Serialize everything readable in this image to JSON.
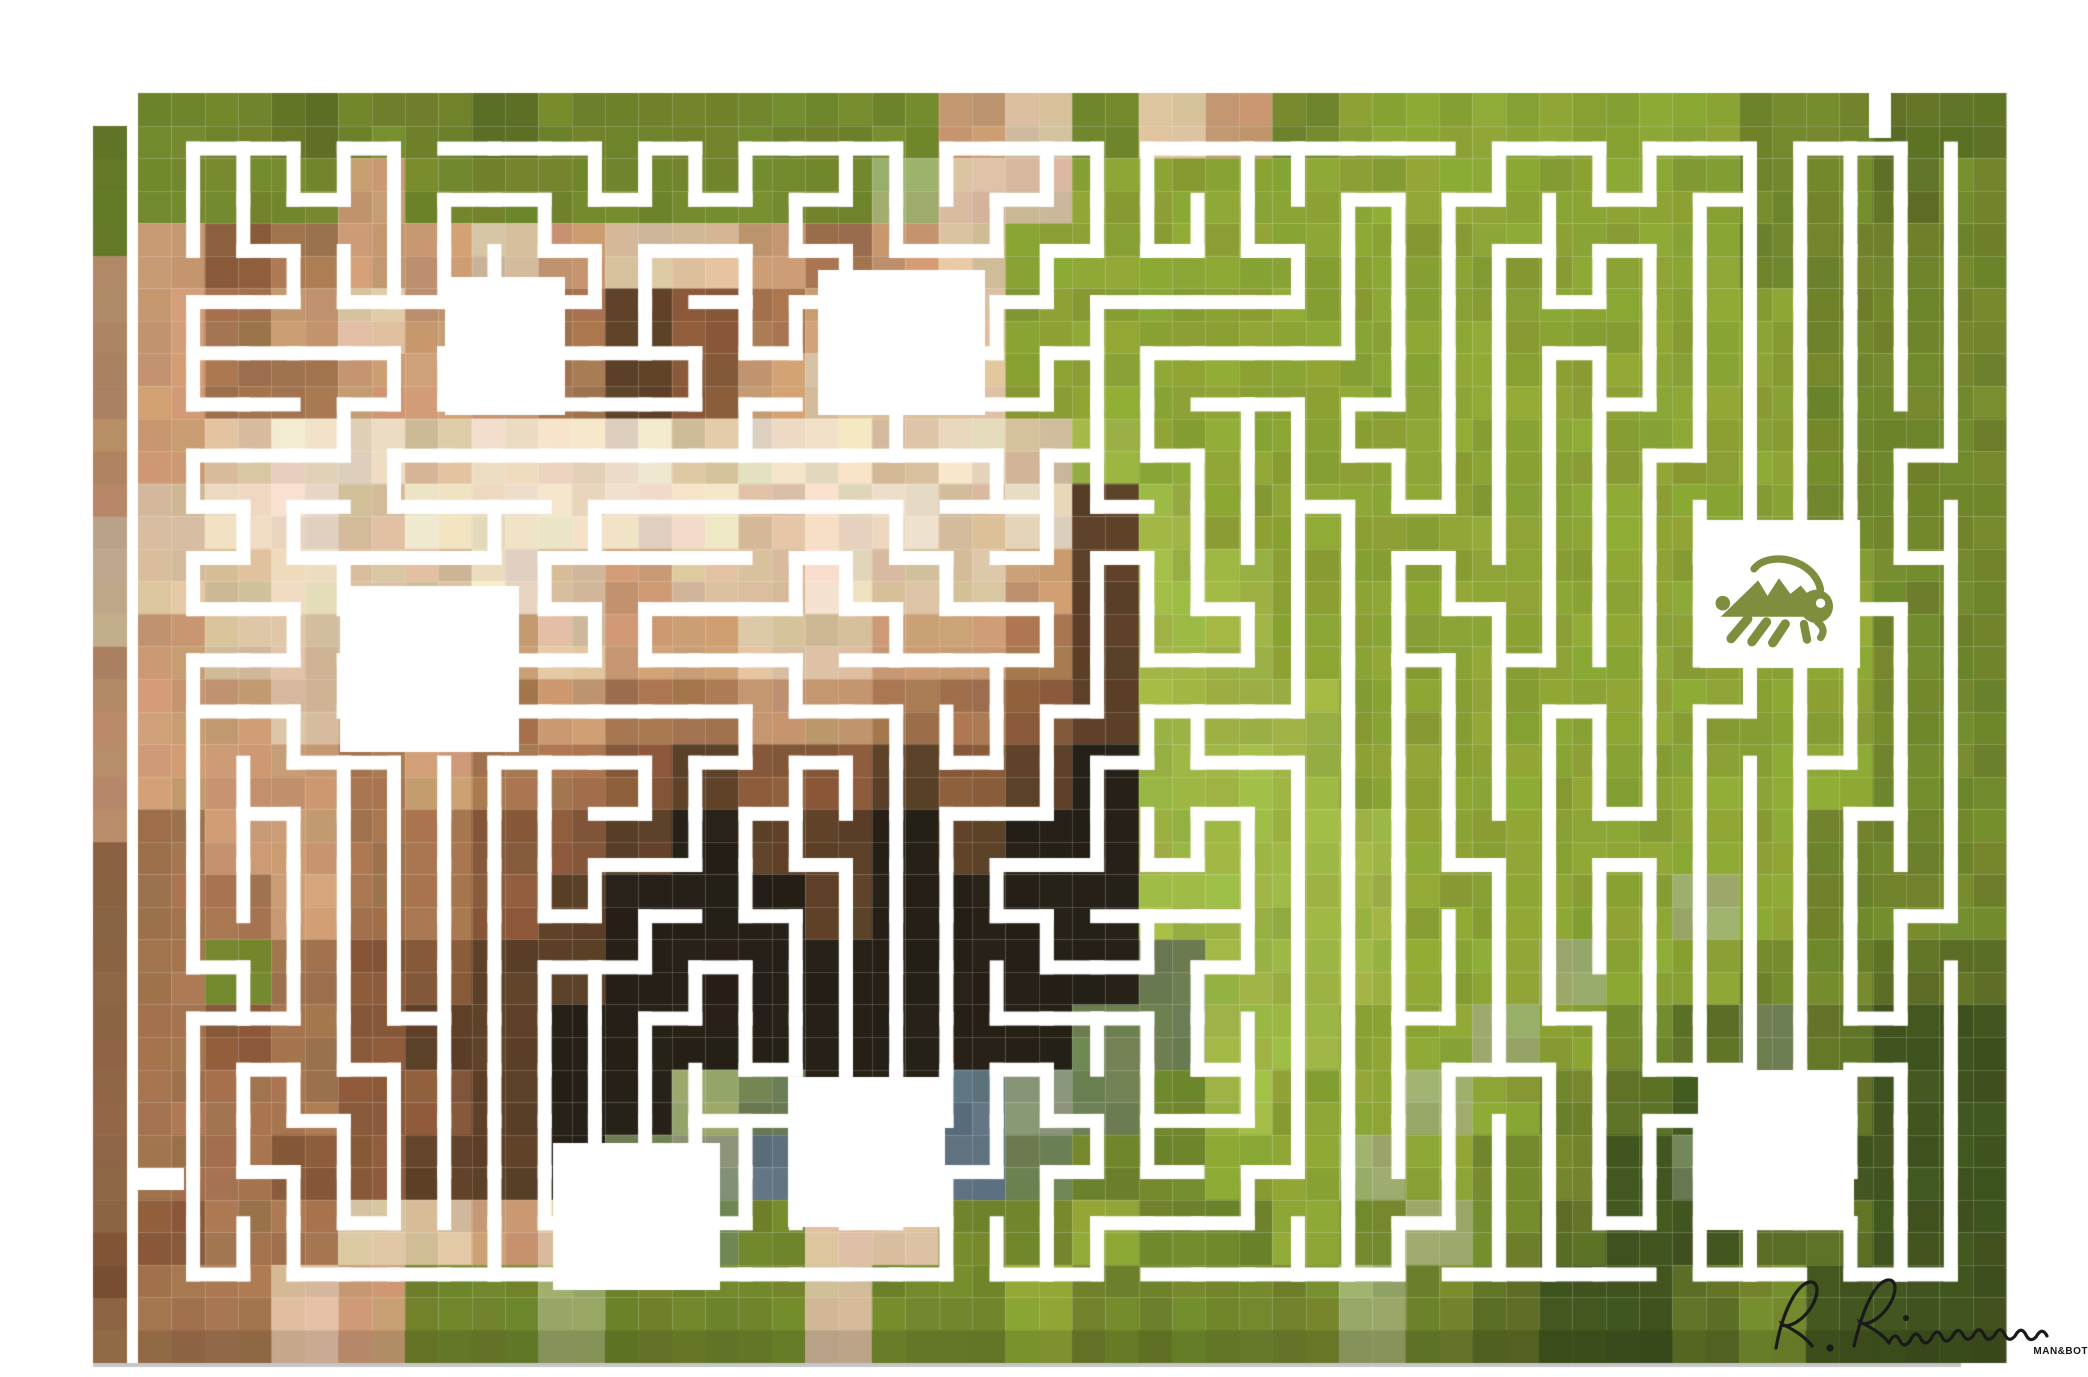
{
  "artwork": {
    "alt": "Pixel-mosaic photograph of a cream and brown dog standing on green grass, carved through with a white maze; a green grasshopper icon sits inside a white room at the right; artist signature and small watermark at bottom right",
    "watermark": "MAN&BOT",
    "signature": "R. Rimmermann",
    "colors": {
      "background": "#ffffff",
      "maze_path": "#ffffff",
      "grasshopper": "#7d8e3e",
      "signature": "#1a1a1a",
      "watermark": "#161616",
      "shadow_edge_line": "#c6c6c6",
      "seam": "rgba(255,255,255,0.18)"
    },
    "canvas": {
      "x": 138,
      "y": 93,
      "w": 1868,
      "h": 1237,
      "cols": 56,
      "rows": 38,
      "border_inset": 30
    },
    "shadow": {
      "left_x": 93,
      "left_top": 126,
      "left_w": 34,
      "bottom_y": 1330,
      "bottom_h": 33,
      "darken": 0.88,
      "edge_line_y": 1363,
      "edge_line_h": 4
    },
    "maze": {
      "cols": 36,
      "rows": 23,
      "path_width": 14,
      "seed": 1337,
      "openings": [
        {
          "x": 1869,
          "y": 93,
          "w": 22,
          "h": 45
        },
        {
          "x": 138,
          "y": 1168,
          "w": 46,
          "h": 22
        }
      ]
    },
    "rooms": [
      {
        "x": 445,
        "y": 277,
        "w": 120,
        "h": 138
      },
      {
        "x": 818,
        "y": 270,
        "w": 167,
        "h": 145
      },
      {
        "x": 340,
        "y": 586,
        "w": 179,
        "h": 166
      },
      {
        "x": 788,
        "y": 1077,
        "w": 157,
        "h": 150
      },
      {
        "x": 553,
        "y": 1143,
        "w": 167,
        "h": 147
      },
      {
        "x": 1700,
        "y": 520,
        "w": 160,
        "h": 148,
        "contains": "grasshopper-icon"
      },
      {
        "x": 1698,
        "y": 1070,
        "w": 156,
        "h": 160
      }
    ],
    "grasshopper": {
      "room_index": 5,
      "w": 136,
      "h": 104
    },
    "signature_box": {
      "x": 1768,
      "y": 1272,
      "w": 312,
      "h": 100
    },
    "watermark_box": {
      "x": 2010,
      "y": 1346,
      "w": 78
    },
    "palette": {
      "a": "#5f7226",
      "b": "#71862c",
      "c": "#8ba334",
      "d": "#9db444",
      "e": "#9aa96a",
      "f": "#41551f",
      "g": "#6d7f52",
      "h": "#ecdcc3",
      "i": "#d9bf9e",
      "j": "#c99a72",
      "k": "#a5754f",
      "l": "#8a5a3a",
      "m": "#5d4128",
      "n": "#262017",
      "o": "#5e7280",
      "p": "#8a9678"
    },
    "pixel_rows": [
      "bbabbabbbbbbjibijbccccccbbaa",
      "bbbjbbbbbbbeiiccccccccccbbab",
      "jlkjjijiijkjicccccccccccbbbb",
      "jkjijjkmlkjjiccccccccccccbbb",
      "jkkjjjkmljiiiccccccccccccbbb",
      "jihhihhhihhihidccccccccccbbb",
      "ihhihhhhhihhihmdcccccccccbbb",
      "iihiihijiihiijmddcccccccccbb",
      "jiiijjijjiijjkmddcccccccccbb",
      "jjijjkjkkjjkklmdddccccccccbb",
      "jjjkjkklmllmlmndddccccccccbb",
      "kjjkkllmnmmnmnnddddccccccbbb",
      "kkjkklmnnnmnnnnddddccccecbbb",
      "kbkllmmnnnnnnnngdddcceccbbaa",
      "klklmmnnnnnnnnggddccecbagaff",
      "kkkllmnnegnnopgbdccecbafgaff",
      "kkllmmngpomnogbbccecbbfgafff",
      "lkkiijipgbiibbcbbcbebaffaaff",
      "kkijbbebbbibbcbbbbebaffabfff"
    ]
  }
}
